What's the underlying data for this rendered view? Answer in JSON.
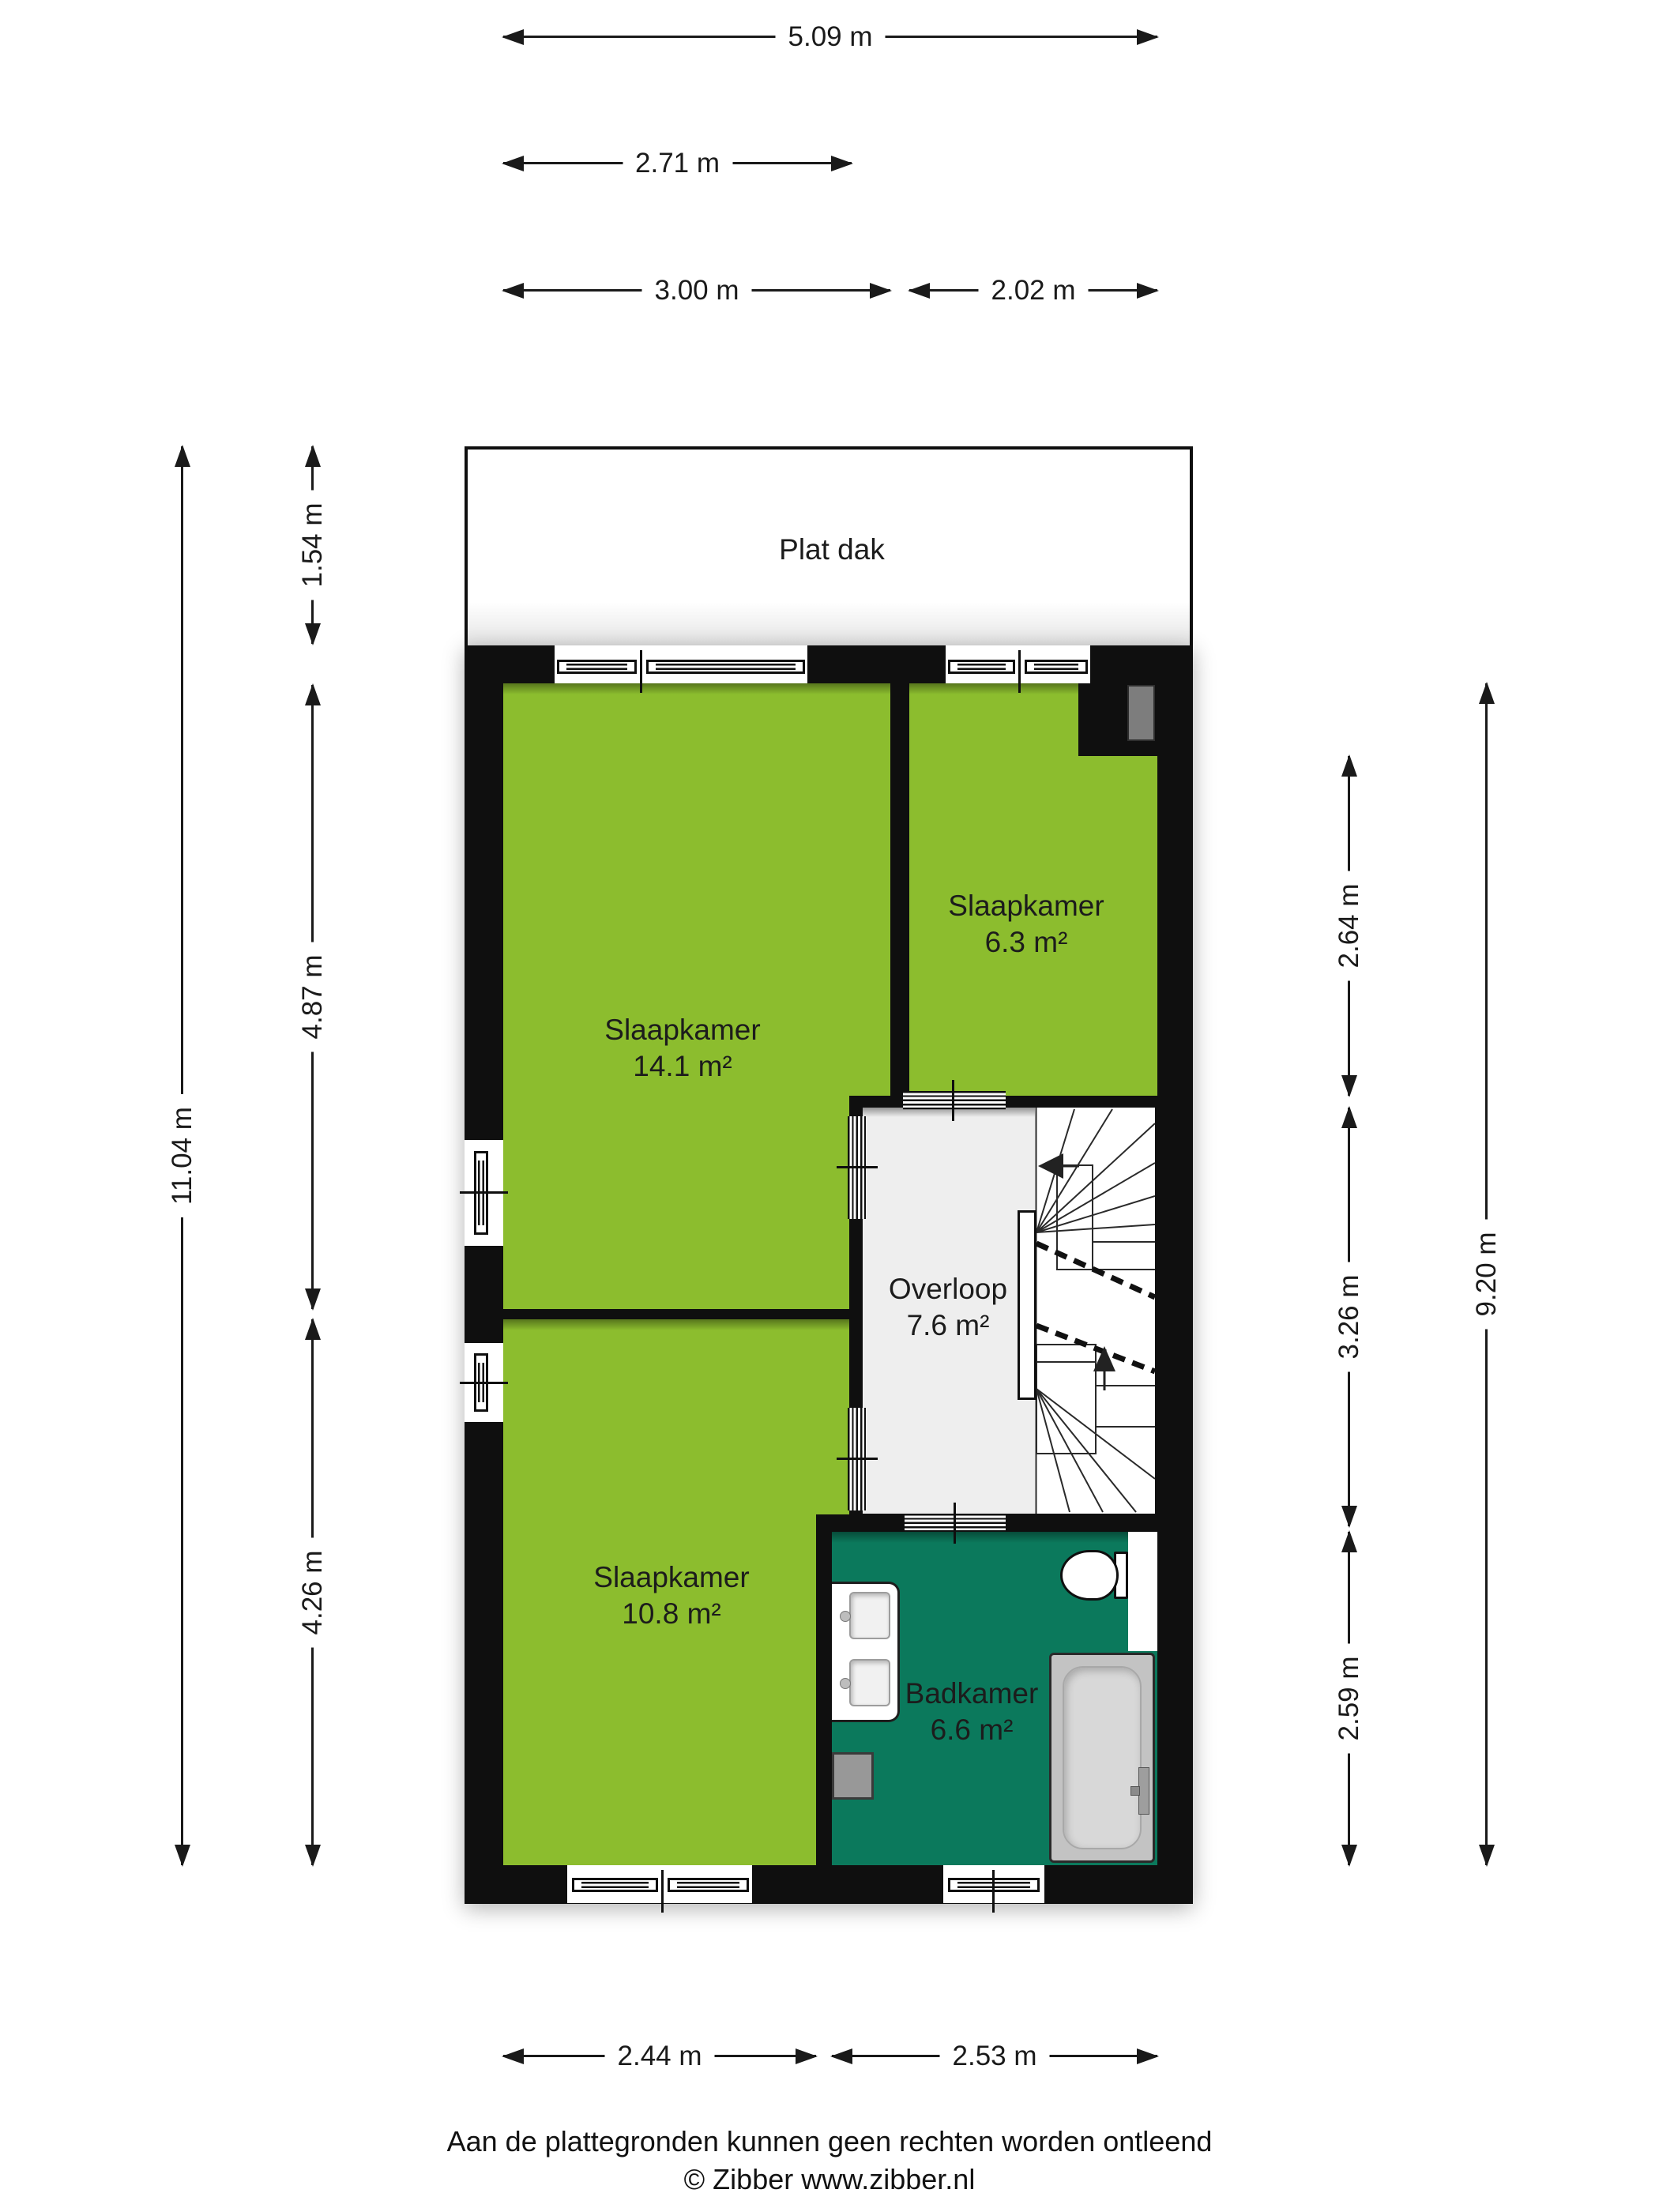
{
  "roof": {
    "label": "Plat dak"
  },
  "rooms": {
    "slaapkamer1": {
      "name": "Slaapkamer",
      "area": "14.1 m²"
    },
    "slaapkamer2": {
      "name": "Slaapkamer",
      "area": "6.3 m²"
    },
    "slaapkamer3": {
      "name": "Slaapkamer",
      "area": "10.8 m²"
    },
    "overloop": {
      "name": "Overloop",
      "area": "7.6 m²"
    },
    "badkamer": {
      "name": "Badkamer",
      "area": "6.6 m²"
    }
  },
  "dimensions": {
    "top": {
      "total": "5.09 m",
      "landing_width": "2.71 m",
      "bedroom1": "3.00 m",
      "bedroom2": "2.02 m"
    },
    "left": {
      "total": "11.04 m",
      "roof": "1.54 m",
      "bedroom1": "4.87 m",
      "bedroom3": "4.26 m"
    },
    "right": {
      "total": "9.20 m",
      "bedroom2": "2.64 m",
      "overloop": "3.26 m",
      "badkamer": "2.59 m"
    },
    "bottom": {
      "bedroom3": "2.44 m",
      "badkamer": "2.53 m"
    }
  },
  "footer": {
    "disclaimer": "Aan de plattegronden kunnen geen rechten worden ontleend",
    "copyright": "© Zibber www.zibber.nl"
  },
  "colors": {
    "room_green": "#8cbd2e",
    "bathroom_teal": "#0b795c",
    "wall_black": "#0f0f0f",
    "landing_gray": "#eeeeee",
    "tub_gray": "#c3c3c3",
    "ink": "#1a1a1a"
  }
}
